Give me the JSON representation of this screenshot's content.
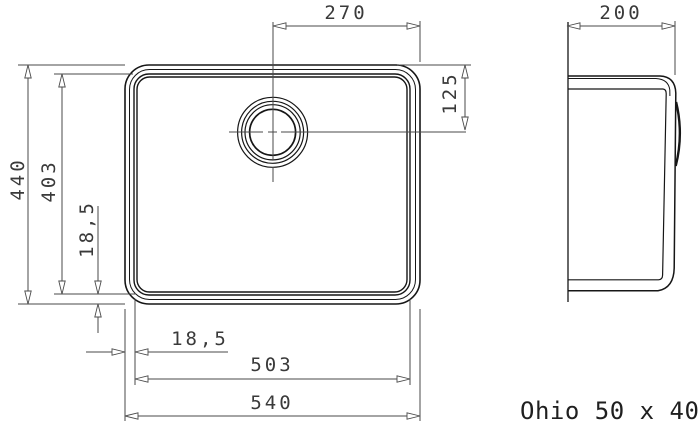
{
  "title": {
    "model_label": "Ohio 50 x 40"
  },
  "dimensions": {
    "drain_center_from_right": "270",
    "side_view_depth": "200",
    "drain_center_from_top": "125",
    "overall_height": "440",
    "bowl_inner_height": "403",
    "rim_width_left": "18,5",
    "rim_width_bottom": "18,5",
    "bowl_inner_width": "503",
    "overall_width": "540"
  },
  "colors": {
    "background": "#ffffff",
    "body_line": "#161616",
    "dimension_line": "#4a4a4a",
    "dimension_text": "#3a3a3a",
    "title_text": "#1f1f1f"
  }
}
